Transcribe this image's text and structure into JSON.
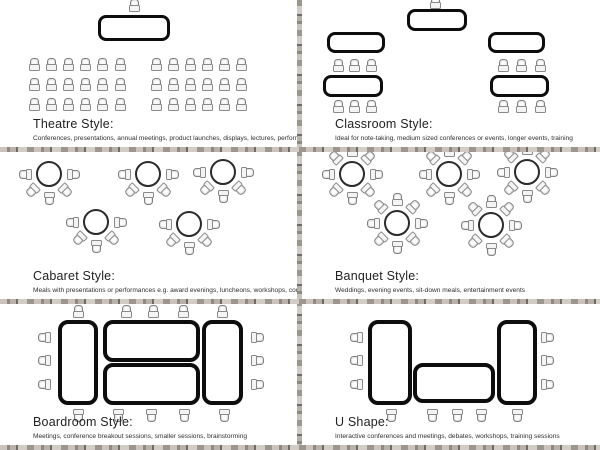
{
  "document_title": "Event seating style diagrams",
  "colors": {
    "background": "#ffffff",
    "table_border": "#0d0d0d",
    "round_table_border": "#2b2b2b",
    "chair_outline": "#808080",
    "divider_texture": "#9a948d",
    "text": "#222222"
  },
  "panels": [
    {
      "id": "theatre",
      "title": "Theatre Style:",
      "description": "Conferences, presentations, annual meetings, product launches, displays, lectures, performances",
      "diagram": {
        "tables": [
          {
            "shape": "rect",
            "x": 98,
            "y": 15,
            "w": 72,
            "h": 26,
            "stroke": 3,
            "radius": 8
          }
        ],
        "seating": [
          {
            "type": "points",
            "rot": 0,
            "pts": [
              [
                134,
                5
              ]
            ]
          },
          {
            "type": "grid",
            "x": 34,
            "y": 64,
            "cols": 6,
            "rows": 3,
            "dx": 17.2,
            "dy": 20,
            "rot": 0
          },
          {
            "type": "grid",
            "x": 156,
            "y": 64,
            "cols": 6,
            "rows": 3,
            "dx": 17,
            "dy": 20,
            "rot": 0
          }
        ]
      }
    },
    {
      "id": "classroom",
      "title": "Classroom Style:",
      "description": "Ideal for note-taking, medium sized conferences or events, longer events, training",
      "diagram": {
        "tables": [
          {
            "shape": "rect",
            "x": 105,
            "y": 9,
            "w": 60,
            "h": 22,
            "stroke": 3,
            "radius": 8
          },
          {
            "shape": "rect",
            "x": 25,
            "y": 32,
            "w": 58,
            "h": 21,
            "stroke": 3,
            "radius": 8
          },
          {
            "shape": "rect",
            "x": 21,
            "y": 75,
            "w": 60,
            "h": 22,
            "stroke": 3,
            "radius": 8
          },
          {
            "shape": "rect",
            "x": 186,
            "y": 32,
            "w": 57,
            "h": 21,
            "stroke": 3,
            "radius": 8
          },
          {
            "shape": "rect",
            "x": 188,
            "y": 75,
            "w": 59,
            "h": 22,
            "stroke": 3,
            "radius": 8
          }
        ],
        "seating": [
          {
            "type": "points",
            "rot": 0,
            "pts": [
              [
                133,
                2
              ]
            ]
          },
          {
            "type": "grid",
            "x": 36,
            "y": 65,
            "cols": 3,
            "rows": 1,
            "dx": 16.5,
            "dy": 0,
            "rot": 0
          },
          {
            "type": "grid",
            "x": 36,
            "y": 106,
            "cols": 3,
            "rows": 1,
            "dx": 16.5,
            "dy": 0,
            "rot": 0
          },
          {
            "type": "grid",
            "x": 201,
            "y": 65,
            "cols": 3,
            "rows": 1,
            "dx": 18.5,
            "dy": 0,
            "rot": 0
          },
          {
            "type": "grid",
            "x": 201,
            "y": 106,
            "cols": 3,
            "rows": 1,
            "dx": 18.5,
            "dy": 0,
            "rot": 0
          }
        ]
      }
    },
    {
      "id": "cabaret",
      "title": "Cabaret Style:",
      "description": "Meals with presentations or performances e.g. award evenings, luncheons, workshops, conferences",
      "diagram": {
        "tables": [
          {
            "shape": "round",
            "cx": 49,
            "cy": 22,
            "r": 13
          },
          {
            "shape": "round",
            "cx": 148,
            "cy": 22,
            "r": 13
          },
          {
            "shape": "round",
            "cx": 223,
            "cy": 20,
            "r": 13
          },
          {
            "shape": "round",
            "cx": 96,
            "cy": 70,
            "r": 13
          },
          {
            "shape": "round",
            "cx": 189,
            "cy": 72,
            "r": 13
          }
        ],
        "seating": [
          {
            "type": "arc",
            "cx": 49,
            "cy": 22,
            "r": 24,
            "angles": [
              90,
              135,
              180,
              225,
              270
            ]
          },
          {
            "type": "arc",
            "cx": 148,
            "cy": 22,
            "r": 24,
            "angles": [
              90,
              135,
              180,
              225,
              270
            ]
          },
          {
            "type": "arc",
            "cx": 223,
            "cy": 20,
            "r": 24,
            "angles": [
              90,
              135,
              180,
              225,
              270
            ]
          },
          {
            "type": "arc",
            "cx": 96,
            "cy": 70,
            "r": 24,
            "angles": [
              90,
              135,
              180,
              225,
              270
            ]
          },
          {
            "type": "arc",
            "cx": 189,
            "cy": 72,
            "r": 24,
            "angles": [
              90,
              135,
              180,
              225,
              270
            ]
          }
        ]
      }
    },
    {
      "id": "banquet",
      "title": "Banquet Style:",
      "description": "Weddings, evening events, sit-down meals, entertainment events",
      "diagram": {
        "tables": [
          {
            "shape": "round",
            "cx": 50,
            "cy": 22,
            "r": 13
          },
          {
            "shape": "round",
            "cx": 147,
            "cy": 22,
            "r": 13
          },
          {
            "shape": "round",
            "cx": 225,
            "cy": 20,
            "r": 13
          },
          {
            "shape": "round",
            "cx": 95,
            "cy": 71,
            "r": 13
          },
          {
            "shape": "round",
            "cx": 189,
            "cy": 73,
            "r": 13
          }
        ],
        "seating": [
          {
            "type": "arc",
            "cx": 50,
            "cy": 22,
            "r": 24,
            "angles": [
              0,
              45,
              90,
              135,
              180,
              225,
              270,
              315
            ]
          },
          {
            "type": "arc",
            "cx": 147,
            "cy": 22,
            "r": 24,
            "angles": [
              0,
              45,
              90,
              135,
              180,
              225,
              270,
              315
            ]
          },
          {
            "type": "arc",
            "cx": 225,
            "cy": 20,
            "r": 24,
            "angles": [
              0,
              45,
              90,
              135,
              180,
              225,
              270,
              315
            ]
          },
          {
            "type": "arc",
            "cx": 95,
            "cy": 71,
            "r": 24,
            "angles": [
              0,
              45,
              90,
              135,
              180,
              225,
              270,
              315
            ]
          },
          {
            "type": "arc",
            "cx": 189,
            "cy": 73,
            "r": 24,
            "angles": [
              0,
              45,
              90,
              135,
              180,
              225,
              270,
              315
            ]
          }
        ]
      }
    },
    {
      "id": "boardroom",
      "title": "Boardroom Style:",
      "description": "Meetings, conference breakout sessions, smaller sessions, brainstorming",
      "diagram": {
        "tables": [
          {
            "shape": "rect",
            "x": 58,
            "y": 16,
            "w": 40,
            "h": 85,
            "stroke": 4.5,
            "radius": 10
          },
          {
            "shape": "rect",
            "x": 103,
            "y": 16,
            "w": 97,
            "h": 42,
            "stroke": 4.5,
            "radius": 10
          },
          {
            "shape": "rect",
            "x": 103,
            "y": 59,
            "w": 97,
            "h": 42,
            "stroke": 4.5,
            "radius": 10
          },
          {
            "shape": "rect",
            "x": 202,
            "y": 16,
            "w": 41,
            "h": 85,
            "stroke": 4.5,
            "radius": 10
          }
        ],
        "seating": [
          {
            "type": "points",
            "rot": 0,
            "pts": [
              [
                78,
                7
              ],
              [
                126,
                7
              ],
              [
                153,
                7
              ],
              [
                183,
                7
              ],
              [
                222,
                7
              ]
            ]
          },
          {
            "type": "points",
            "rot": 180,
            "pts": [
              [
                78,
                111
              ],
              [
                118,
                111
              ],
              [
                151,
                111
              ],
              [
                184,
                111
              ],
              [
                224,
                111
              ]
            ]
          },
          {
            "type": "points",
            "rot": 270,
            "pts": [
              [
                44,
                33
              ],
              [
                44,
                56
              ],
              [
                44,
                80
              ]
            ]
          },
          {
            "type": "points",
            "rot": 90,
            "pts": [
              [
                257,
                33
              ],
              [
                257,
                56
              ],
              [
                257,
                80
              ]
            ]
          }
        ]
      }
    },
    {
      "id": "ushape",
      "title": "U Shape:",
      "description": "Interactive conferences and meetings, debates, workshops, training sessions",
      "diagram": {
        "tables": [
          {
            "shape": "rect",
            "x": 66,
            "y": 16,
            "w": 44,
            "h": 85,
            "stroke": 4.5,
            "radius": 10
          },
          {
            "shape": "rect",
            "x": 195,
            "y": 16,
            "w": 40,
            "h": 85,
            "stroke": 4.5,
            "radius": 10
          },
          {
            "shape": "rect",
            "x": 111,
            "y": 59,
            "w": 82,
            "h": 40,
            "stroke": 4.5,
            "radius": 10
          }
        ],
        "seating": [
          {
            "type": "points",
            "rot": 270,
            "pts": [
              [
                54,
                33
              ],
              [
                54,
                56
              ],
              [
                54,
                80
              ]
            ]
          },
          {
            "type": "points",
            "rot": 90,
            "pts": [
              [
                245,
                33
              ],
              [
                245,
                56
              ],
              [
                245,
                80
              ]
            ]
          },
          {
            "type": "points",
            "rot": 180,
            "pts": [
              [
                89,
                111
              ],
              [
                130,
                111
              ],
              [
                155,
                111
              ],
              [
                179,
                111
              ],
              [
                215,
                111
              ]
            ]
          }
        ]
      }
    }
  ]
}
